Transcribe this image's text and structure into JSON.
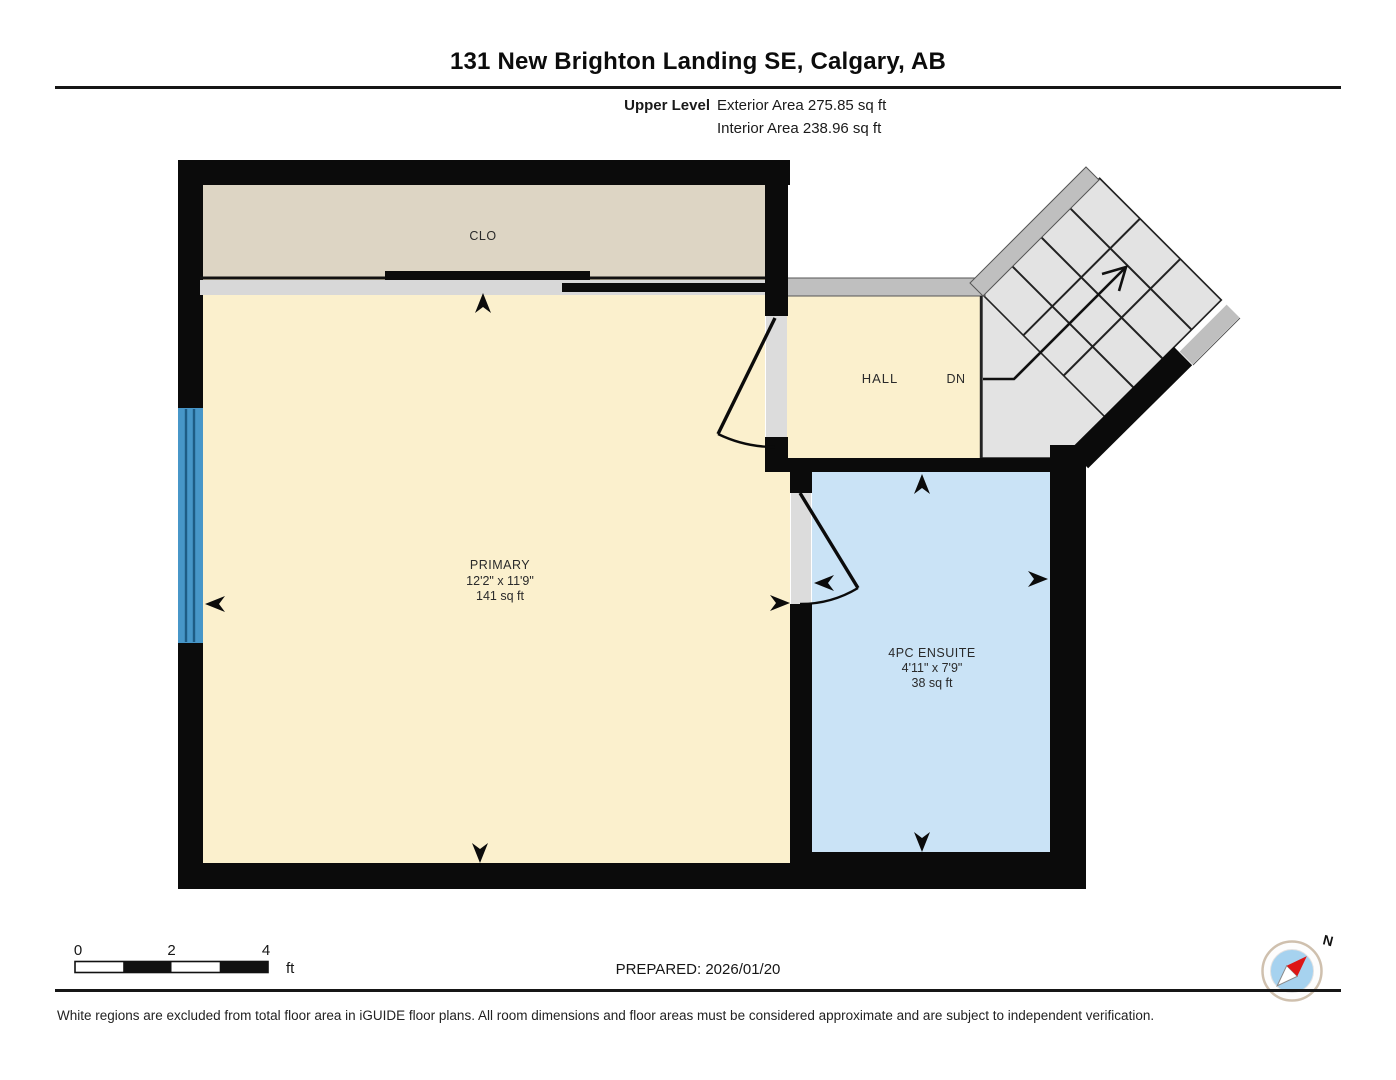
{
  "header": {
    "title": "131 New Brighton Landing SE, Calgary, AB",
    "level_label": "Upper Level",
    "exterior_area": "Exterior Area 275.85 sq ft",
    "interior_area": "Interior Area 238.96 sq ft"
  },
  "rooms": {
    "closet": {
      "label": "CLO"
    },
    "hall": {
      "label": "HALL"
    },
    "stairs": {
      "direction_label": "DN"
    },
    "primary": {
      "label": "PRIMARY",
      "dimensions": "12'2\" x 11'9\"",
      "area": "141 sq ft"
    },
    "ensuite": {
      "label": "4PC ENSUITE",
      "dimensions": "4'11\" x 7'9\"",
      "area": "38 sq ft"
    }
  },
  "scale_bar": {
    "tick_0": "0",
    "tick_2": "2",
    "tick_4": "4",
    "unit": "ft"
  },
  "compass": {
    "north_label": "N"
  },
  "footer": {
    "prepared": "PREPARED: 2026/01/20",
    "disclaimer": "White regions are excluded from total floor area in iGUIDE floor plans. All room dimensions and floor areas must be considered approximate and are subject to independent verification."
  },
  "colors": {
    "wall": "#0b0b0b",
    "gray_wall": "#bfbfbf",
    "closet_floor": "#ddd5c4",
    "room_floor_yellow": "#fbf0cd",
    "ensuite_floor_blue": "#cae3f6",
    "stairs_floor": "#e3e3e3",
    "window_blue": "#4796c8",
    "compass_blue": "#a6d2ef",
    "compass_red": "#dd1515"
  }
}
